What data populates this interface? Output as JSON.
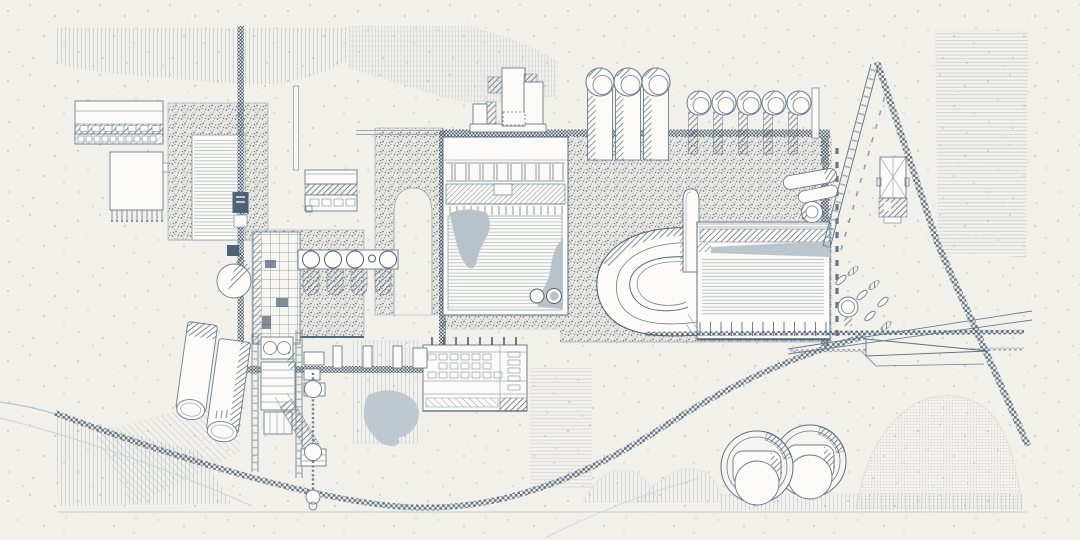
{
  "document": {
    "title": "Industrial site plan — monochrome blue ink technical drawing on speckled paper",
    "type": "architectural-site-plan",
    "orientation": "landscape",
    "visible_text": ""
  },
  "palette": {
    "paper": "#f2f0ea",
    "ink": "#4e6275",
    "mid": "#6b7d8c",
    "light": "#9aa8b4",
    "pale": "#c3ccd3",
    "wash": "#b7c2ca",
    "white": "#fbfaf6",
    "stipple_bg": "#e8e6df"
  },
  "elements": [
    {
      "name": "warehouse-left-top",
      "desc": "rectangular hall with hatched loading band"
    },
    {
      "name": "warehouse-left-lower",
      "desc": "hall with comb-like footing row"
    },
    {
      "name": "stippled-yard-left",
      "desc": "speckled ground frame with ruled interior"
    },
    {
      "name": "main-vertical-pipeline",
      "desc": "checkered pipe running top to bottom with valve"
    },
    {
      "name": "small-shed",
      "desc": "small hatched-band shed"
    },
    {
      "name": "arch-gallery",
      "desc": "stippled band with white arch opening"
    },
    {
      "name": "central-hall",
      "desc": "large hall: column row, hatched band, ruled floor, two gray ponds, two round vats"
    },
    {
      "name": "stepped-plant-tower",
      "desc": "cluster of stepped rectangular volumes"
    },
    {
      "name": "three-large-stacks",
      "desc": "three open-top cylindrical stacks"
    },
    {
      "name": "five-small-stacks",
      "desc": "row of five open cylinders on hatched stems"
    },
    {
      "name": "gallery-pipe-top",
      "desc": "long dark checkered gallery pipe"
    },
    {
      "name": "right-process-hall",
      "desc": "hall with hatched roof band, gray wedge, ruled floor, tick footing"
    },
    {
      "name": "curved-conveyor",
      "desc": "C-shaped return conveyor loop"
    },
    {
      "name": "round-chimney",
      "desc": "round-top duct tower"
    },
    {
      "name": "inclined-conveyor-ladder",
      "desc": "diagonal ladder conveyor"
    },
    {
      "name": "checkered-footpath-diagonal",
      "desc": "checkered path crossing right field"
    },
    {
      "name": "hip-roof-hut",
      "desc": "small hut in plan with X roof and hatched apron"
    },
    {
      "name": "pond-and-shrubs",
      "desc": "round basin and leaf-shaped shrubs"
    },
    {
      "name": "rail-siding",
      "desc": "checkered rail with switch blade"
    },
    {
      "name": "loading-office-block",
      "desc": "gridded flat building with hatched dock"
    },
    {
      "name": "tilted-storage-tanks",
      "desc": "two tilted cylindrical tanks"
    },
    {
      "name": "lattice-tower",
      "desc": "scaffold lattice with chute"
    },
    {
      "name": "bead-chain-drill",
      "desc": "vertical chain with bead circles"
    },
    {
      "name": "circle-battery",
      "desc": "row of round cells on hatched stubs"
    },
    {
      "name": "round-clarifier-tanks",
      "desc": "two circular tanks bottom right"
    },
    {
      "name": "terrain-textures",
      "desc": "striped, bricked, ruled and dotted ground fields"
    },
    {
      "name": "checkered-road-curve",
      "desc": "long curved checkered road bottom left"
    }
  ]
}
